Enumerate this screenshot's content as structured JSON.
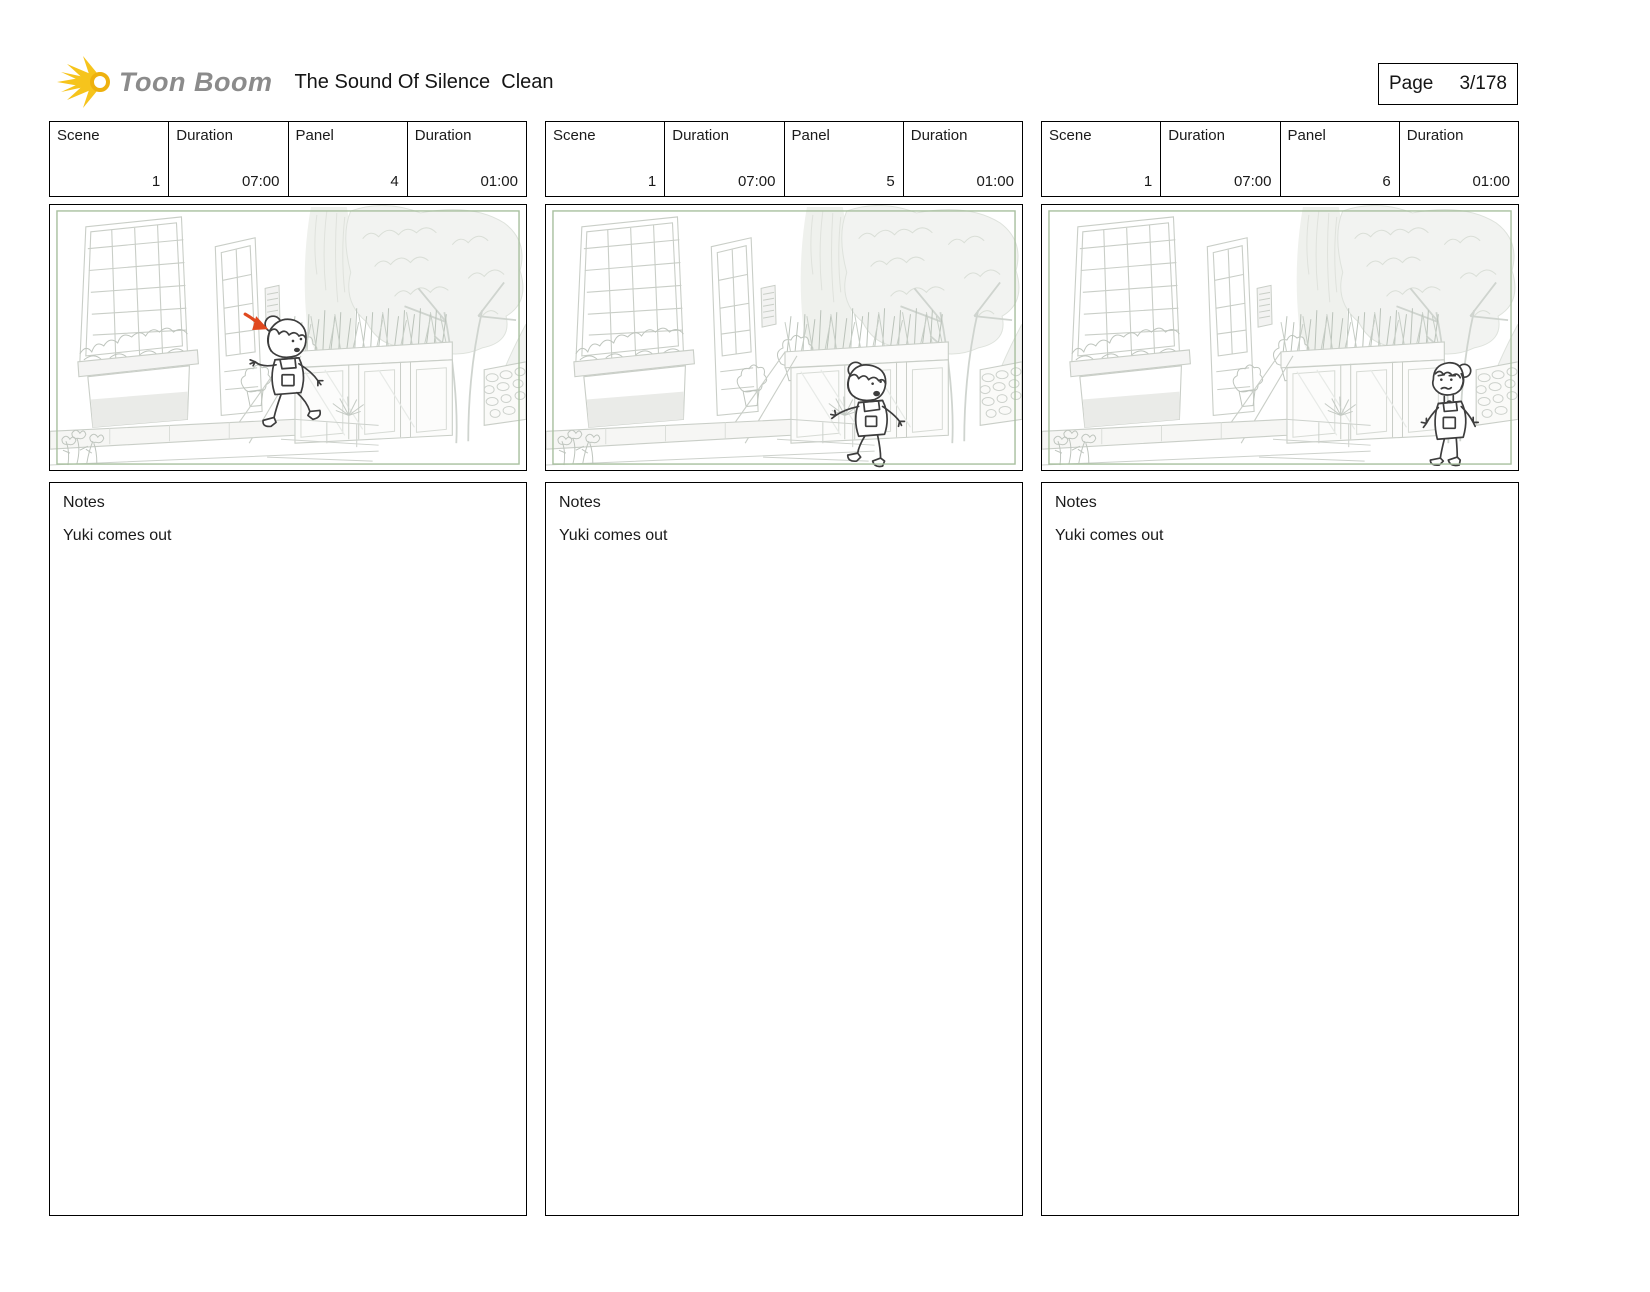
{
  "header": {
    "logo_text": "Toon Boom",
    "title": "The Sound Of Silence  Clean",
    "page_label": "Page",
    "page_number": "3/178"
  },
  "labels": {
    "scene": "Scene",
    "duration": "Duration",
    "panel": "Panel",
    "notes": "Notes"
  },
  "panels": [
    {
      "scene": "1",
      "scene_duration": "07:00",
      "panel": "4",
      "panel_duration": "01:00",
      "notes": "Yuki comes out",
      "annotation": "red motion arrow pointing at character"
    },
    {
      "scene": "1",
      "scene_duration": "07:00",
      "panel": "5",
      "panel_duration": "01:00",
      "notes": "Yuki comes out",
      "annotation": ""
    },
    {
      "scene": "1",
      "scene_duration": "07:00",
      "panel": "6",
      "panel_duration": "01:00",
      "notes": "Yuki comes out",
      "annotation": ""
    }
  ],
  "colors": {
    "camera_frame_green": "#a7bf9e",
    "arrow_red": "#e0491f",
    "character_ink": "#3d3d3d",
    "sketch_line": "#c5cac3",
    "logo_gray": "#8b8b8b",
    "logo_yellow": "#f6c41c"
  }
}
